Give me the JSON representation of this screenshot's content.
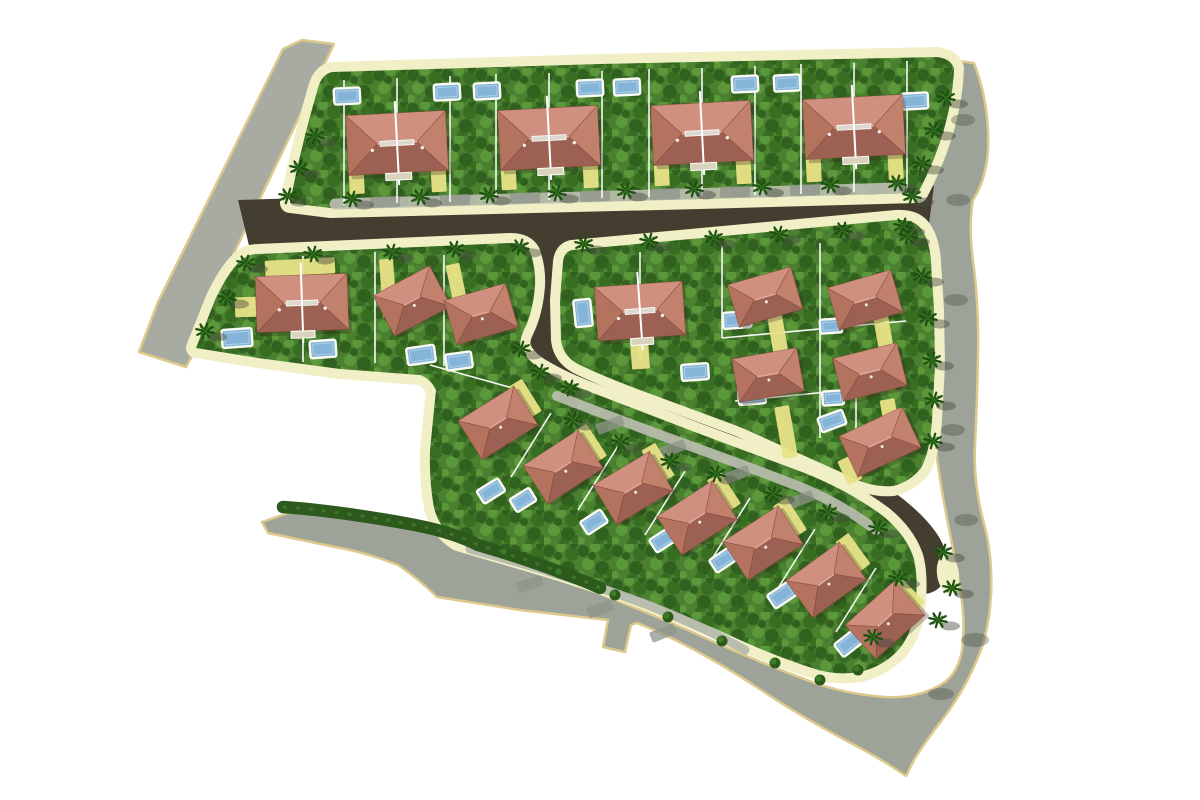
{
  "canvas": {
    "width": 1200,
    "height": 800,
    "background": "#ffffff"
  },
  "palette": {
    "paper": "#ffffff",
    "road_gray_upper": "#a8aba2",
    "road_gray_main": "#9da398",
    "road_edge_tan": "#dcc98b",
    "road_dark": "#443e30",
    "sidewalk_cream": "#f1efc5",
    "lane_light": "#bcbfb1",
    "lane_light2": "#b3b7ab",
    "lane_blob": "#90948b",
    "lawn_base": "#4a8030",
    "lawn_dark": "#2d5c1b",
    "lawn_mid": "#356b20",
    "lawn_light": "#5d9c3c",
    "hedge": "#2c5a1d",
    "lot_line": "#ffffff",
    "driveway_yellow": "#e8e288",
    "pool_blue": "#84b5d8",
    "pool_rim": "#fbfbf2",
    "roof_light": "#d09080",
    "roof_dark": "#9c6153",
    "roof_left": "#b3735f",
    "roof_right": "#c2816d",
    "roof_outline": "rgba(120,60,42,0.5)",
    "ridge_highlight": "#e2ab97",
    "house_shadow": "rgba(50,35,25,0.28)",
    "porch": "#d9d2bd",
    "vent": "#ddd8ce",
    "palm_dark": "#1e4f13",
    "palm_light": "#3b7d22",
    "palm_center": "#2c641a",
    "shadow_gray": "rgba(72,74,64,0.45)"
  },
  "format_notes": {
    "rect_arrays": "[cx, cy, w, h, rotation_deg]",
    "point_arrays": "[x, y]",
    "segment_arrays": "[x1, y1, x2, y2]",
    "house_arrays": "[cx, cy, w, h, rotation_deg, type] type b=large twin villa, m=detached villa"
  },
  "roads": {
    "outer": [
      {
        "name": "existing-road-upper-left",
        "fill": "road_gray_upper",
        "d": "M302,40 L334,44 L215,293 L192,356 L186,367 L139,352 L158,302 L283,49 Z"
      },
      {
        "name": "existing-road-perimeter",
        "fill": "road_gray_main",
        "d": "M262,522 L300,509 L375,520 L448,538 Q510,560 570,582 Q630,605 690,631 Q750,659 812,682 Q845,694 885,697 Q920,699 945,682 Q962,668 963,640 Q965,615 960,590 Q955,560 949,528 Q942,495 937,458 Q933,430 933,395 Q933,355 934,318 Q935,285 928,258 Q922,232 916,206 Q913,195 915,185 Q925,135 948,60 L974,63 Q990,105 988,150 Q986,180 973,200 Q968,228 974,268 Q979,310 978,355 Q977,405 975,445 Q973,480 983,520 Q993,555 991,595 Q989,630 979,655 Q965,690 942,720 Q925,742 914,760 L906,776 Q880,758 845,740 Q800,716 758,688 Q720,663 685,645 Q660,632 637,623 L631,625 L625,652 L603,647 L608,620 L520,610 L437,597 Q420,580 398,565 Q365,552 335,547 L268,533 Z"
      }
    ],
    "inner_polygons": [
      {
        "name": "internal-road-main",
        "d": "M238,200 L908,179 L934,186 L926,246 L252,258 Z"
      }
    ],
    "inner_strokes": [
      {
        "name": "internal-road-loop",
        "width": 48,
        "d": "M545,234 C560,276 558,312 543,336 C534,354 552,370 582,384 C662,416 742,446 802,470 C846,487 886,512 908,536 C920,549 925,559 923,570"
      }
    ],
    "lanes": [
      {
        "d": "M335,204 L900,188",
        "width": 11,
        "color": "lane_light"
      },
      {
        "d": "M557,396 Q640,428 718,456 Q770,475 800,487 Q840,503 876,530",
        "width": 10,
        "color": "lane_light"
      },
      {
        "d": "M470,549 Q560,573 640,602 Q700,625 745,650",
        "width": 9,
        "color": "lane_light2"
      }
    ],
    "lane_blobs": [
      [
        385,
        202,
        30,
        11,
        -2
      ],
      [
        455,
        200,
        30,
        11,
        -2
      ],
      [
        525,
        198,
        30,
        11,
        -2
      ],
      [
        595,
        196,
        30,
        11,
        -2
      ],
      [
        665,
        194,
        30,
        11,
        -2
      ],
      [
        735,
        192,
        30,
        11,
        -2
      ],
      [
        805,
        190,
        30,
        11,
        -2
      ],
      [
        610,
        425,
        28,
        11,
        -21
      ],
      [
        672,
        449,
        28,
        11,
        -21
      ],
      [
        736,
        475,
        28,
        11,
        -21
      ],
      [
        800,
        500,
        28,
        11,
        -22
      ],
      [
        530,
        584,
        26,
        11,
        -17
      ],
      [
        600,
        609,
        26,
        11,
        -20
      ],
      [
        663,
        633,
        26,
        11,
        -22
      ]
    ],
    "shadow_blobs": [
      [
        963,
        120,
        12,
        6
      ],
      [
        958,
        200,
        12,
        6
      ],
      [
        956,
        300,
        12,
        6
      ],
      [
        953,
        430,
        12,
        6
      ],
      [
        966,
        520,
        12,
        6
      ],
      [
        975,
        640,
        14,
        7
      ],
      [
        941,
        694,
        13,
        6
      ]
    ]
  },
  "blocks": [
    {
      "name": "residential-block-north",
      "d": "M290,203 Q300,150 318,88 Q322,74 332,72 L600,64 L936,57 Q950,58 954,68 Q952,128 918,193 L700,199 L330,208 Z"
    },
    {
      "name": "residential-block-west-and-south-strip",
      "d": "M196,348 L215,300 Q230,268 244,258 Q250,254 258,254 L510,243 Q525,243 530,252 Q536,268 535,286 Q533,312 524,330 Q518,342 522,350 Q528,362 545,371 Q560,380 585,390 L700,434 L802,472 Q848,490 883,516 Q905,534 913,556 Q918,572 916,600 Q914,630 900,648 Q885,666 860,672 Q835,676 812,668 Q780,658 740,640 Q690,617 640,598 Q590,580 540,565 L458,541 Q440,530 434,508 Q429,480 430,450 L436,390 Q430,378 420,375 L340,369 L258,358 Z"
    },
    {
      "name": "residential-block-east",
      "d": "M563,262 Q564,252 572,250 L896,220 Q915,219 922,230 Q930,242 931,262 L934,310 L935,365 L932,420 Q930,452 921,468 Q910,482 893,486 Q870,488 845,474 L740,427 L640,390 Q600,375 578,364 Q563,356 561,340 L560,300 Z"
    }
  ],
  "cream_patches": [
    [
      948,
      574,
      11,
      20,
      -8
    ]
  ],
  "lot_lines": [
    [
      344,
      80,
      344,
      205
    ],
    [
      397,
      78,
      397,
      203
    ],
    [
      450,
      76,
      450,
      202
    ],
    [
      496,
      74,
      496,
      201
    ],
    [
      549,
      73,
      549,
      200
    ],
    [
      602,
      71,
      602,
      198
    ],
    [
      649,
      69,
      649,
      197
    ],
    [
      702,
      68,
      702,
      196
    ],
    [
      755,
      66,
      755,
      195
    ],
    [
      801,
      64,
      801,
      194
    ],
    [
      854,
      63,
      854,
      192
    ],
    [
      907,
      61,
      907,
      191
    ],
    [
      303,
      256,
      303,
      362
    ],
    [
      375,
      252,
      375,
      363
    ],
    [
      444,
      255,
      444,
      366
    ],
    [
      430,
      365,
      516,
      389
    ],
    [
      640,
      252,
      640,
      360
    ],
    [
      722,
      246,
      722,
      338
    ],
    [
      820,
      243,
      820,
      438
    ],
    [
      722,
      338,
      906,
      321
    ],
    [
      735,
      401,
      900,
      385
    ],
    [
      856,
      386,
      856,
      462
    ],
    [
      551,
      413,
      511,
      477
    ],
    [
      618,
      446,
      578,
      510
    ],
    [
      685,
      471,
      645,
      535
    ],
    [
      750,
      498,
      710,
      562
    ],
    [
      815,
      529,
      775,
      593
    ],
    [
      876,
      568,
      836,
      632
    ]
  ],
  "driveways": [
    [
      356,
      168,
      15,
      52,
      -3
    ],
    [
      438,
      166,
      15,
      52,
      -3
    ],
    [
      508,
      164,
      15,
      52,
      -3
    ],
    [
      590,
      162,
      15,
      52,
      -3
    ],
    [
      661,
      160,
      15,
      52,
      -3
    ],
    [
      743,
      158,
      15,
      52,
      -3
    ],
    [
      813,
      156,
      15,
      52,
      -3
    ],
    [
      895,
      154,
      15,
      52,
      -3
    ],
    [
      300,
      267,
      70,
      16,
      -3
    ],
    [
      388,
      288,
      14,
      58,
      -4
    ],
    [
      458,
      291,
      14,
      55,
      -12
    ],
    [
      248,
      307,
      26,
      20,
      -2
    ],
    [
      640,
      354,
      18,
      30,
      -4
    ],
    [
      778,
      336,
      15,
      42,
      -10
    ],
    [
      884,
      336,
      15,
      42,
      -10
    ],
    [
      786,
      432,
      15,
      52,
      -10
    ],
    [
      891,
      422,
      15,
      46,
      -10
    ],
    [
      850,
      470,
      16,
      26,
      -25
    ],
    [
      525,
      399,
      16,
      38,
      -32
    ],
    [
      590,
      444,
      16,
      38,
      -33
    ],
    [
      658,
      463,
      16,
      38,
      -31
    ],
    [
      724,
      492,
      16,
      38,
      -33
    ],
    [
      790,
      518,
      16,
      38,
      -33
    ],
    [
      853,
      553,
      16,
      38,
      -36
    ],
    [
      908,
      596,
      16,
      32,
      -45
    ]
  ],
  "pools": [
    [
      347,
      96,
      26,
      16,
      -3
    ],
    [
      447,
      92,
      26,
      16,
      -3
    ],
    [
      487,
      91,
      26,
      16,
      -3
    ],
    [
      590,
      88,
      26,
      16,
      -3
    ],
    [
      627,
      87,
      26,
      16,
      -3
    ],
    [
      745,
      84,
      26,
      16,
      -3
    ],
    [
      787,
      83,
      26,
      16,
      -3
    ],
    [
      915,
      101,
      26,
      16,
      -3
    ],
    [
      237,
      338,
      30,
      18,
      -4
    ],
    [
      323,
      349,
      26,
      17,
      -4
    ],
    [
      421,
      355,
      28,
      17,
      -8
    ],
    [
      459,
      361,
      26,
      16,
      -8
    ],
    [
      583,
      313,
      17,
      27,
      -6
    ],
    [
      695,
      372,
      27,
      16,
      -4
    ],
    [
      737,
      320,
      28,
      16,
      -4
    ],
    [
      831,
      326,
      22,
      14,
      -4
    ],
    [
      752,
      396,
      27,
      16,
      -4
    ],
    [
      833,
      398,
      21,
      14,
      -4
    ],
    [
      832,
      421,
      26,
      15,
      -20
    ],
    [
      491,
      491,
      25,
      15,
      -32
    ],
    [
      523,
      500,
      23,
      15,
      -32
    ],
    [
      594,
      522,
      24,
      15,
      -33
    ],
    [
      663,
      540,
      24,
      15,
      -33
    ],
    [
      723,
      560,
      24,
      15,
      -34
    ],
    [
      782,
      595,
      26,
      16,
      -34
    ],
    [
      849,
      643,
      26,
      16,
      -38
    ]
  ],
  "houses": [
    [
      397,
      143,
      100,
      60,
      -3,
      "b"
    ],
    [
      549,
      138,
      100,
      60,
      -3,
      "b"
    ],
    [
      702,
      133,
      100,
      60,
      -3,
      "b"
    ],
    [
      854,
      127,
      100,
      60,
      -3,
      "b"
    ],
    [
      302,
      303,
      92,
      56,
      -2,
      "b"
    ],
    [
      640,
      311,
      88,
      54,
      -4,
      "b"
    ],
    [
      412,
      301,
      64,
      46,
      -28,
      "m"
    ],
    [
      481,
      314,
      64,
      46,
      -16,
      "m"
    ],
    [
      765,
      297,
      66,
      44,
      -16,
      "m"
    ],
    [
      865,
      300,
      66,
      44,
      -16,
      "m"
    ],
    [
      768,
      375,
      66,
      44,
      -10,
      "m"
    ],
    [
      870,
      372,
      66,
      44,
      -14,
      "m"
    ],
    [
      880,
      442,
      70,
      45,
      -25,
      "m"
    ],
    [
      498,
      423,
      66,
      46,
      -32,
      "m"
    ],
    [
      563,
      467,
      66,
      46,
      -33,
      "m"
    ],
    [
      633,
      488,
      66,
      46,
      -31,
      "m"
    ],
    [
      697,
      518,
      66,
      46,
      -33,
      "m"
    ],
    [
      763,
      543,
      66,
      46,
      -33,
      "m"
    ],
    [
      826,
      580,
      66,
      46,
      -36,
      "m"
    ],
    [
      885,
      620,
      66,
      46,
      -42,
      "m"
    ]
  ],
  "hedges": [
    {
      "d": "M283,507 Q340,511 415,525 Q455,533 478,545 Q530,560 565,574 Q585,581 600,588",
      "width": 12.5
    }
  ],
  "bushes": [
    [
      505,
      553
    ],
    [
      560,
      573
    ],
    [
      615,
      595
    ],
    [
      668,
      617
    ],
    [
      722,
      641
    ],
    [
      775,
      663
    ],
    [
      820,
      680
    ],
    [
      858,
      670
    ]
  ],
  "palms": [
    [
      352,
      199
    ],
    [
      420,
      197
    ],
    [
      489,
      195
    ],
    [
      557,
      193
    ],
    [
      626,
      191
    ],
    [
      694,
      189
    ],
    [
      762,
      187
    ],
    [
      830,
      185
    ],
    [
      897,
      183
    ],
    [
      313,
      254
    ],
    [
      392,
      252
    ],
    [
      455,
      249
    ],
    [
      520,
      247
    ],
    [
      584,
      244
    ],
    [
      649,
      241
    ],
    [
      714,
      238
    ],
    [
      779,
      234
    ],
    [
      843,
      230
    ],
    [
      903,
      226
    ],
    [
      315,
      136
    ],
    [
      299,
      168
    ],
    [
      288,
      196
    ],
    [
      246,
      263
    ],
    [
      227,
      298
    ],
    [
      205,
      331
    ],
    [
      521,
      349
    ],
    [
      540,
      372
    ],
    [
      570,
      388
    ],
    [
      573,
      420
    ],
    [
      620,
      442
    ],
    [
      670,
      461
    ],
    [
      716,
      474
    ],
    [
      773,
      494
    ],
    [
      828,
      512
    ],
    [
      878,
      528
    ],
    [
      943,
      552
    ],
    [
      952,
      588
    ],
    [
      898,
      578
    ],
    [
      938,
      620
    ],
    [
      873,
      637
    ],
    [
      946,
      98
    ],
    [
      934,
      130
    ],
    [
      922,
      164
    ],
    [
      912,
      196
    ],
    [
      908,
      236
    ],
    [
      922,
      276
    ],
    [
      928,
      318
    ],
    [
      932,
      360
    ],
    [
      934,
      400
    ],
    [
      933,
      441
    ]
  ]
}
